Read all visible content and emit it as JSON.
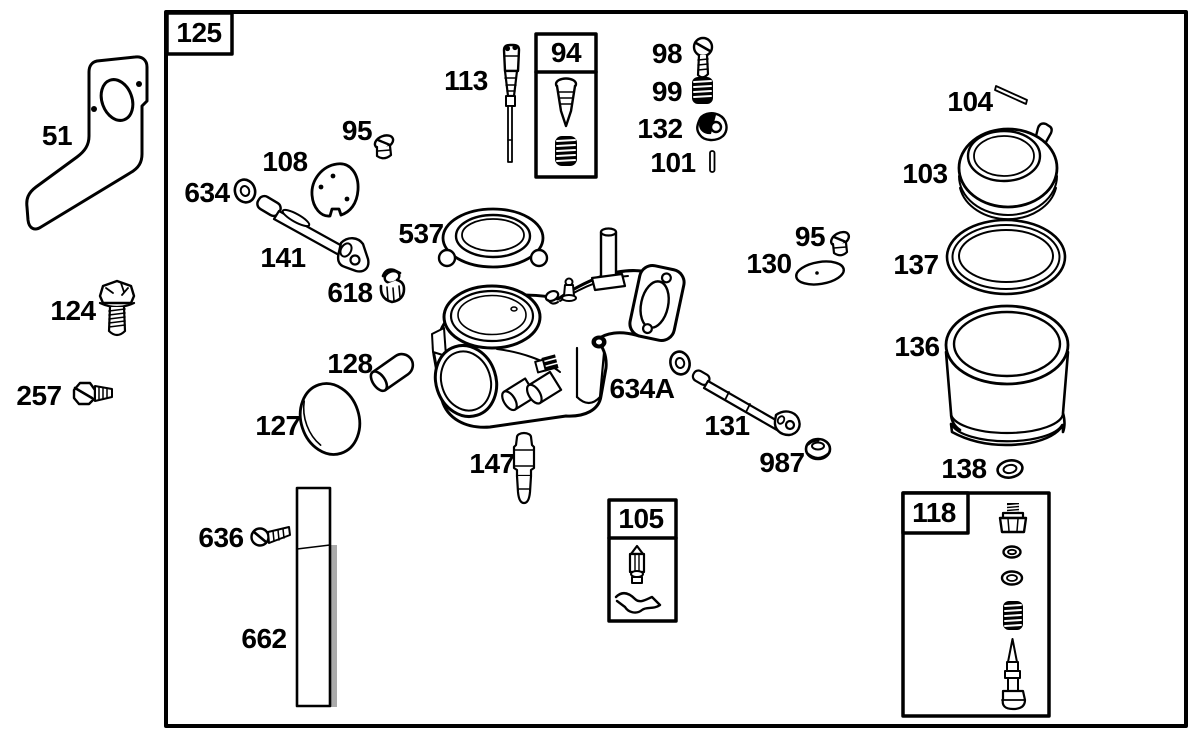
{
  "figure": {
    "background_color": "#ffffff",
    "ink_color": "#000000",
    "description": "Exploded parts diagram of a carburetor assembly with numbered callouts and grouped-part boxes"
  },
  "labels": [
    {
      "text": "125"
    },
    {
      "text": "51"
    },
    {
      "text": "124"
    },
    {
      "text": "257"
    },
    {
      "text": "634"
    },
    {
      "text": "108"
    },
    {
      "text": "95"
    },
    {
      "text": "113"
    },
    {
      "text": "94"
    },
    {
      "text": "98"
    },
    {
      "text": "99"
    },
    {
      "text": "132"
    },
    {
      "text": "101"
    },
    {
      "text": "104"
    },
    {
      "text": "103"
    },
    {
      "text": "537"
    },
    {
      "text": "141"
    },
    {
      "text": "618"
    },
    {
      "text": "95"
    },
    {
      "text": "130"
    },
    {
      "text": "137"
    },
    {
      "text": "136"
    },
    {
      "text": "128"
    },
    {
      "text": "127"
    },
    {
      "text": "634A"
    },
    {
      "text": "131"
    },
    {
      "text": "987"
    },
    {
      "text": "147"
    },
    {
      "text": "138"
    },
    {
      "text": "105"
    },
    {
      "text": "118"
    },
    {
      "text": "636"
    },
    {
      "text": "662"
    }
  ]
}
